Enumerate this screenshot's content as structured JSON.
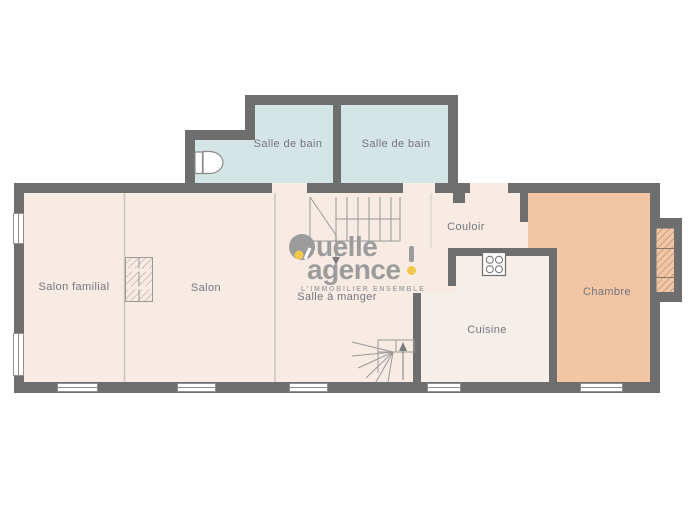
{
  "title": "Floor plan",
  "rooms": {
    "bathroom1": "Salle de bain",
    "bathroom2": "Salle de bain",
    "family_room": "Salon familial",
    "living_room": "Salon",
    "dining_room": "Salle à manger",
    "hallway": "Couloir",
    "kitchen": "Cuisine",
    "bedroom": "Chambre"
  },
  "brand": {
    "name": "quelle agence !",
    "line1": "uelle",
    "line2": "agence",
    "tagline": "L'IMMOBILIER ENSEMBLE"
  },
  "icons": {
    "toilet": "toilet-icon",
    "stove": "stove-icon",
    "stairs_up": "stairs-up-icon",
    "stairs_down": "stairs-down-icon",
    "fireplace": "fireplace-icon",
    "chimney": "chimney-icon"
  },
  "colors": {
    "wall": "#6e6e6e",
    "bathroom_floor": "#d3e5e4",
    "living_floor": "#f7ebe4",
    "kitchen_floor": "#f6efe9",
    "bedroom_floor": "#f2c5a5",
    "logo_gray": "#9c9c9c",
    "logo_yellow": "#f2c84b"
  }
}
